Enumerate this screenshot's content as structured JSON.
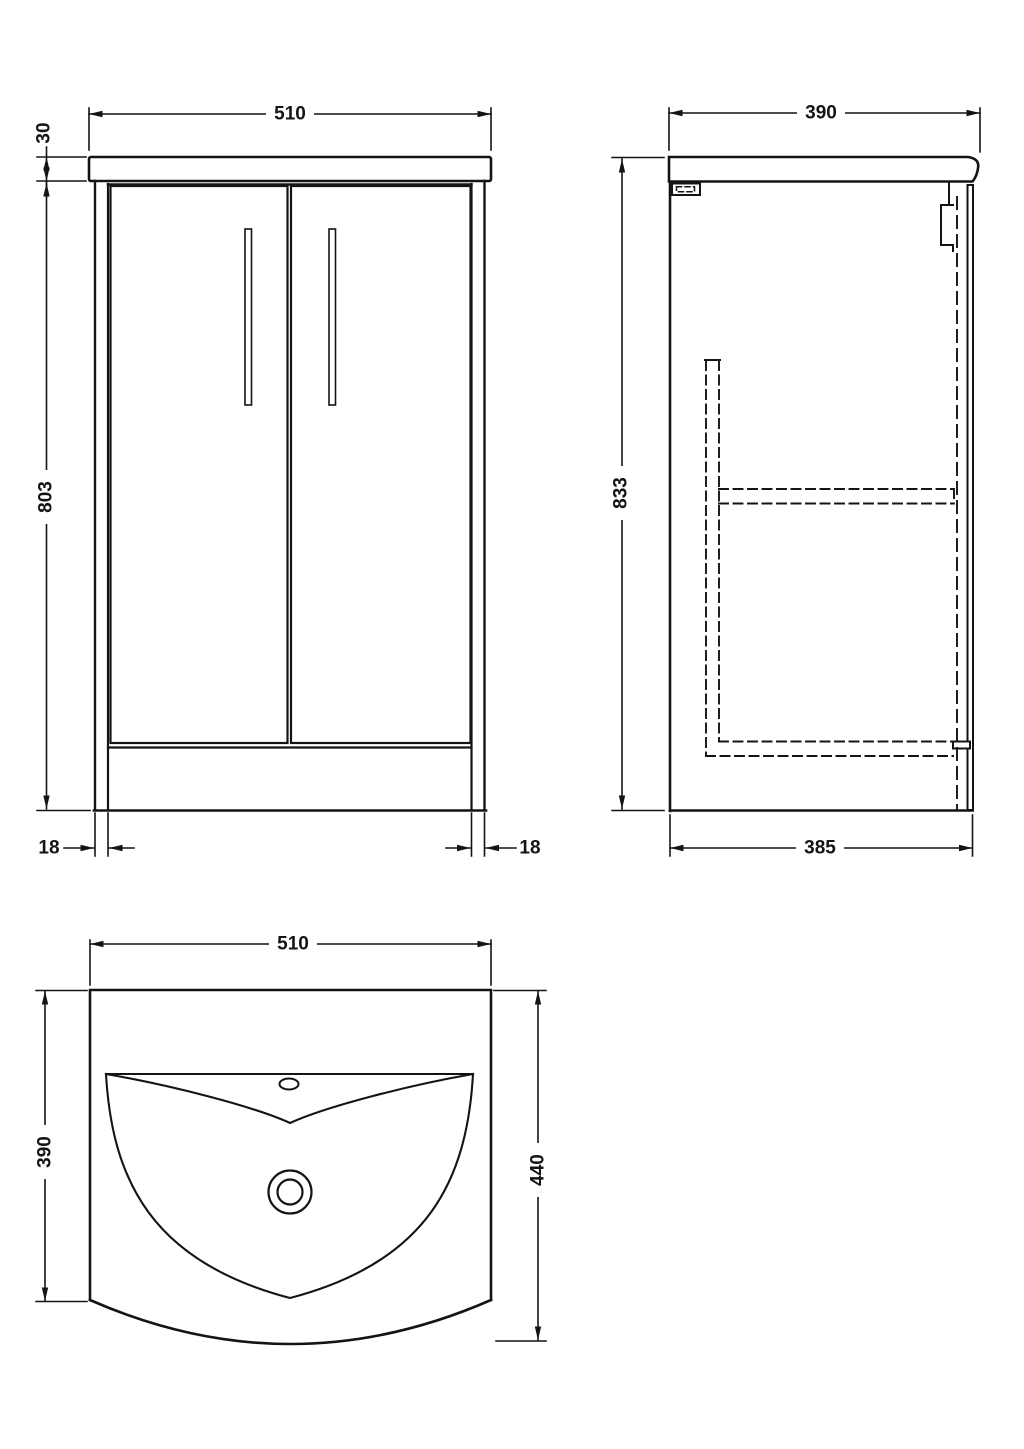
{
  "colors": {
    "background": "#ffffff",
    "line": "#141414"
  },
  "dims": {
    "front": {
      "width": "510",
      "counter_thickness": "30",
      "cabinet_height": "803",
      "panel_left": "18",
      "panel_right": "18"
    },
    "side": {
      "depth": "390",
      "overall_height": "833",
      "cabinet_depth": "385"
    },
    "plan": {
      "width": "510",
      "carcass_depth": "390",
      "overall_depth": "440"
    }
  }
}
